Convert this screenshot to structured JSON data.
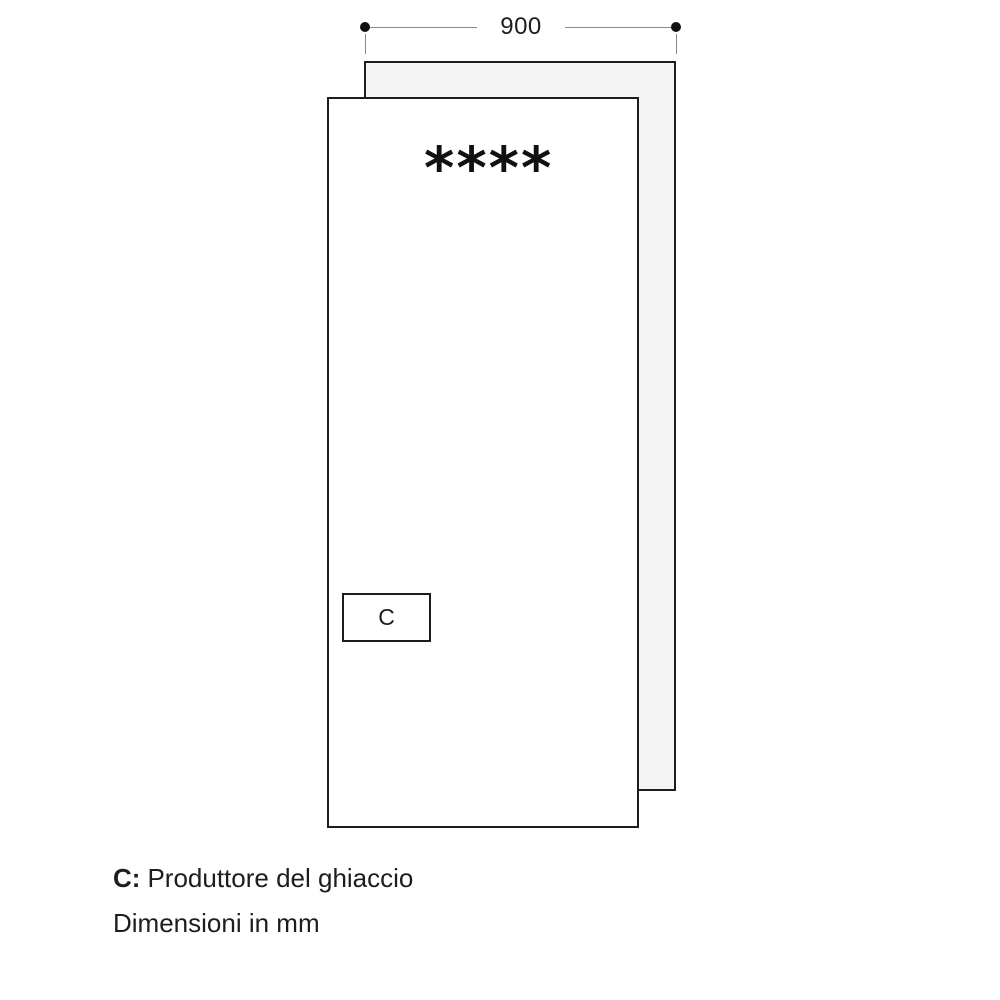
{
  "diagram": {
    "dimension_top": {
      "value": "900"
    },
    "door_panel": {
      "star_rating": "****",
      "ice_maker": {
        "label": "C"
      }
    },
    "legend": {
      "key": "C:",
      "definition": "Produttore del ghiaccio"
    },
    "units_note": "Dimensioni in mm",
    "colors": {
      "outline": "#1d1d1b",
      "back_panel_fill": "#f4f4f4",
      "dimension_line": "#8a8a8a",
      "endpoint_dot": "#111111",
      "text": "#1d1d1b"
    }
  }
}
